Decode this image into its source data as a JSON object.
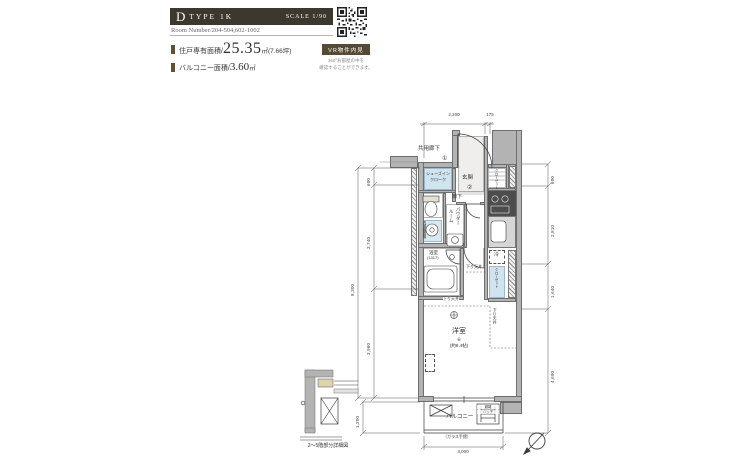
{
  "colors": {
    "header_bar": "#3d382f",
    "accent_brown": "#5f5132",
    "badge_brown": "#554a36",
    "closet_blue": "#cfe4ee",
    "wall_gray": "#b3b3b3",
    "line": "#444444"
  },
  "header": {
    "type_letter": "D",
    "type_rest": "TYPE 1K",
    "scale": "SCALE 1/90",
    "room_number": "Room Number/204-504,602-1002",
    "area_label": "住戸専有面積/",
    "area_value": "25.35",
    "area_unit": "㎡(7.66坪)",
    "balcony_label": "バルコニー面積/",
    "balcony_value": "3.60",
    "balcony_unit": "㎡",
    "vr_badge": "VR物件内見",
    "vr_note_line1": "360°お部屋の中を",
    "vr_note_line2": "確認することができます。"
  },
  "plan": {
    "corridor": "共用廊下",
    "entrance": "玄関",
    "sic_line1": "シューズイン",
    "sic_line2": "クローク",
    "closet": "クローゼット",
    "hall": "廊下",
    "powder_line1": "パウダー",
    "powder_line2": "ルーム",
    "bath": "浴室",
    "bath_size": "(1317)",
    "washer": "洗濯機置場",
    "fridge": "冷",
    "room": "洋室",
    "room_note": "⑥",
    "room_size": "(約8.4帖)",
    "down_ceiling": "下り天井",
    "balcony": "バルコニー",
    "hatch_line1": "避難",
    "hatch_line2": "ハッチ",
    "glass_rail": "（ガラス手摺）",
    "note1": "①",
    "note2": "②",
    "inset_caption": "2〜5階部分詳細図",
    "dims": {
      "top": [
        "2,200",
        "175"
      ],
      "left": [
        "600",
        "3,740",
        "3,960"
      ],
      "left_total": "8,300",
      "balcony_left": "1,200",
      "right": [
        "800",
        "2,810",
        "1,640",
        "4,690"
      ],
      "bottom": "3,000"
    }
  }
}
